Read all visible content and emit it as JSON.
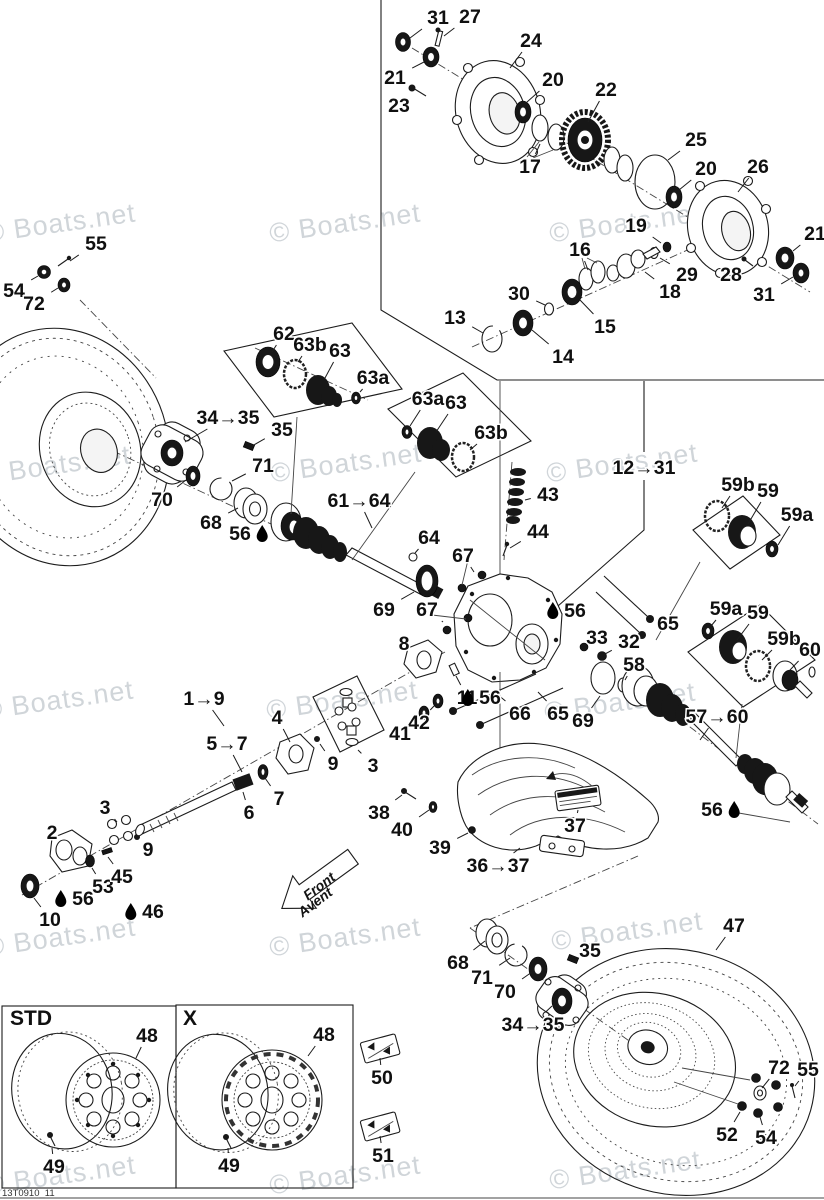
{
  "watermark": {
    "text": "© Boats.net",
    "color": "#c5cbd0",
    "positions": [
      [
        60,
        223
      ],
      [
        345,
        223
      ],
      [
        625,
        223
      ],
      [
        55,
        465
      ],
      [
        346,
        463
      ],
      [
        622,
        463
      ],
      [
        58,
        700
      ],
      [
        342,
        700
      ],
      [
        620,
        702
      ],
      [
        60,
        937
      ],
      [
        345,
        937
      ],
      [
        627,
        931
      ],
      [
        60,
        1175
      ],
      [
        345,
        1175
      ],
      [
        625,
        1170
      ]
    ]
  },
  "footer_code": "13T0910_11",
  "front_arrow": {
    "line1": "Front",
    "line2": "Avent"
  },
  "boxes": {
    "std_label": "STD",
    "x_label": "X"
  },
  "callouts": [
    {
      "t": "31",
      "x": 438,
      "y": 17,
      "lx": 410,
      "ly": 38
    },
    {
      "t": "27",
      "x": 470,
      "y": 16,
      "lx": 444,
      "ly": 36
    },
    {
      "t": "24",
      "x": 531,
      "y": 40,
      "lx": 510,
      "ly": 68
    },
    {
      "t": "21",
      "x": 395,
      "y": 77,
      "lx": 424,
      "ly": 62
    },
    {
      "t": "23",
      "x": 399,
      "y": 105,
      "lx": 412,
      "ly": 93
    },
    {
      "t": "20",
      "x": 553,
      "y": 79,
      "lx": 527,
      "ly": 102
    },
    {
      "t": "22",
      "x": 606,
      "y": 89,
      "lx": 588,
      "ly": 122
    },
    {
      "t": "17",
      "x": 530,
      "y": 166,
      "lx": 540,
      "ly": 144
    },
    {
      "t": "25",
      "x": 696,
      "y": 139,
      "lx": 668,
      "ly": 160
    },
    {
      "t": "20",
      "x": 706,
      "y": 168,
      "lx": 679,
      "ly": 190
    },
    {
      "t": "26",
      "x": 758,
      "y": 166,
      "lx": 738,
      "ly": 192
    },
    {
      "t": "21",
      "x": 815,
      "y": 233,
      "lx": 793,
      "ly": 251
    },
    {
      "t": "31",
      "x": 764,
      "y": 294,
      "lx": 793,
      "ly": 277
    },
    {
      "t": "28",
      "x": 731,
      "y": 274,
      "lx": 744,
      "ly": 263
    },
    {
      "t": "29",
      "x": 687,
      "y": 274,
      "lx": 660,
      "ly": 258
    },
    {
      "t": "18",
      "x": 670,
      "y": 291,
      "lx": 645,
      "ly": 272
    },
    {
      "t": "19",
      "x": 636,
      "y": 225,
      "lx": 661,
      "ly": 243
    },
    {
      "t": "16",
      "x": 580,
      "y": 249,
      "lx": 588,
      "ly": 270
    },
    {
      "t": "15",
      "x": 605,
      "y": 326,
      "lx": 580,
      "ly": 300
    },
    {
      "t": "13",
      "x": 455,
      "y": 317,
      "lx": 483,
      "ly": 333
    },
    {
      "t": "30",
      "x": 519,
      "y": 293,
      "lx": 545,
      "ly": 305
    },
    {
      "t": "14",
      "x": 563,
      "y": 356,
      "lx": 532,
      "ly": 330
    },
    {
      "t": "55",
      "x": 96,
      "y": 243,
      "lx": 70,
      "ly": 261
    },
    {
      "t": "54",
      "x": 14,
      "y": 290,
      "lx": 38,
      "ly": 276
    },
    {
      "t": "72",
      "x": 34,
      "y": 303,
      "lx": 58,
      "ly": 288
    },
    {
      "t": "62",
      "x": 284,
      "y": 333,
      "lx": 272,
      "ly": 352
    },
    {
      "t": "63b",
      "x": 310,
      "y": 344,
      "lx": 298,
      "ly": 362
    },
    {
      "t": "63",
      "x": 340,
      "y": 350,
      "lx": 325,
      "ly": 378
    },
    {
      "t": "63a",
      "x": 373,
      "y": 377,
      "lx": 360,
      "ly": 392
    },
    {
      "t": "34→35",
      "x": 228,
      "y": 417,
      "lx": 185,
      "ly": 442
    },
    {
      "t": "35",
      "x": 282,
      "y": 429,
      "lx": 252,
      "ly": 446
    },
    {
      "t": "71",
      "x": 263,
      "y": 465,
      "lx": 232,
      "ly": 481
    },
    {
      "t": "70",
      "x": 162,
      "y": 499,
      "lx": 186,
      "ly": 480
    },
    {
      "t": "68",
      "x": 211,
      "y": 522,
      "lx": 238,
      "ly": 508
    },
    {
      "t": "56",
      "x": 240,
      "y": 533,
      "lube": "after"
    },
    {
      "t": "61→64",
      "x": 359,
      "y": 500,
      "lx": 372,
      "ly": 528
    },
    {
      "t": "63a",
      "x": 428,
      "y": 398,
      "lx": 410,
      "ly": 426
    },
    {
      "t": "63",
      "x": 456,
      "y": 402,
      "lx": 436,
      "ly": 432
    },
    {
      "t": "63b",
      "x": 491,
      "y": 432,
      "lx": 470,
      "ly": 450
    },
    {
      "t": "43",
      "x": 548,
      "y": 494,
      "lx": 525,
      "ly": 500
    },
    {
      "t": "44",
      "x": 538,
      "y": 531,
      "lx": 510,
      "ly": 548
    },
    {
      "t": "64",
      "x": 429,
      "y": 537,
      "lx": 415,
      "ly": 553
    },
    {
      "t": "67",
      "x": 463,
      "y": 555,
      "lx": 474,
      "ly": 572
    },
    {
      "t": "67",
      "x": 427,
      "y": 609,
      "lx": 443,
      "ly": 622
    },
    {
      "t": "56",
      "x": 575,
      "y": 610,
      "lube": "before"
    },
    {
      "t": "33",
      "x": 597,
      "y": 637,
      "lx": 585,
      "ly": 646
    },
    {
      "t": "32",
      "x": 629,
      "y": 641,
      "lx": 605,
      "ly": 654
    },
    {
      "t": "58",
      "x": 634,
      "y": 664,
      "lx": 625,
      "ly": 680
    },
    {
      "t": "65",
      "x": 668,
      "y": 623,
      "lx": 652,
      "ly": 616
    },
    {
      "t": "66",
      "x": 520,
      "y": 713,
      "lx": 497,
      "ly": 694
    },
    {
      "t": "65",
      "x": 558,
      "y": 713,
      "lx": 538,
      "ly": 692
    },
    {
      "t": "69",
      "x": 583,
      "y": 720,
      "lx": 600,
      "ly": 696
    },
    {
      "t": "11",
      "x": 467,
      "y": 697,
      "lx": 456,
      "ly": 676
    },
    {
      "t": "56",
      "x": 490,
      "y": 697,
      "lube": "before"
    },
    {
      "t": "8",
      "x": 404,
      "y": 643,
      "lx": 414,
      "ly": 655
    },
    {
      "t": "42",
      "x": 419,
      "y": 722,
      "lx": 434,
      "ly": 706
    },
    {
      "t": "41",
      "x": 400,
      "y": 733,
      "lx": 421,
      "ly": 717
    },
    {
      "t": "69",
      "x": 384,
      "y": 609,
      "lx": 414,
      "ly": 592
    },
    {
      "t": "12→31",
      "x": 644,
      "y": 467
    },
    {
      "t": "1→9",
      "x": 204,
      "y": 698,
      "lx": 224,
      "ly": 726
    },
    {
      "t": "5→7",
      "x": 227,
      "y": 743,
      "lx": 242,
      "ly": 772
    },
    {
      "t": "4",
      "x": 277,
      "y": 717,
      "lx": 290,
      "ly": 742
    },
    {
      "t": "9",
      "x": 333,
      "y": 763,
      "lx": 320,
      "ly": 744
    },
    {
      "t": "3",
      "x": 373,
      "y": 765,
      "lx": 358,
      "ly": 750
    },
    {
      "t": "7",
      "x": 279,
      "y": 798,
      "lx": 265,
      "ly": 778
    },
    {
      "t": "6",
      "x": 249,
      "y": 812,
      "lx": 243,
      "ly": 792
    },
    {
      "t": "2",
      "x": 52,
      "y": 832,
      "lx": 62,
      "ly": 844
    },
    {
      "t": "3",
      "x": 105,
      "y": 807,
      "lx": 117,
      "ly": 822
    },
    {
      "t": "9",
      "x": 148,
      "y": 849,
      "lx": 139,
      "ly": 839
    },
    {
      "t": "53",
      "x": 103,
      "y": 886,
      "lx": 92,
      "ly": 868
    },
    {
      "t": "45",
      "x": 122,
      "y": 876,
      "lx": 108,
      "ly": 857
    },
    {
      "t": "56",
      "x": 83,
      "y": 898,
      "lube": "before"
    },
    {
      "t": "46",
      "x": 153,
      "y": 911,
      "lube": "before"
    },
    {
      "t": "10",
      "x": 50,
      "y": 919,
      "lx": 34,
      "ly": 898
    },
    {
      "t": "38",
      "x": 379,
      "y": 812,
      "lx": 402,
      "ly": 795
    },
    {
      "t": "40",
      "x": 402,
      "y": 829,
      "lx": 429,
      "ly": 810
    },
    {
      "t": "39",
      "x": 440,
      "y": 847,
      "lx": 468,
      "ly": 833
    },
    {
      "t": "36→37",
      "x": 498,
      "y": 865,
      "lx": 520,
      "ly": 848
    },
    {
      "t": "37",
      "x": 575,
      "y": 825,
      "lx": 578,
      "ly": 810
    },
    {
      "t": "59b",
      "x": 738,
      "y": 484,
      "lx": 722,
      "ly": 508
    },
    {
      "t": "59",
      "x": 768,
      "y": 490,
      "lx": 748,
      "ly": 524
    },
    {
      "t": "59a",
      "x": 797,
      "y": 514,
      "lx": 778,
      "ly": 545
    },
    {
      "t": "59a",
      "x": 726,
      "y": 608,
      "lx": 711,
      "ly": 626
    },
    {
      "t": "59",
      "x": 758,
      "y": 612,
      "lx": 737,
      "ly": 640
    },
    {
      "t": "59b",
      "x": 784,
      "y": 638,
      "lx": 762,
      "ly": 660
    },
    {
      "t": "60",
      "x": 810,
      "y": 649,
      "lx": 790,
      "ly": 670
    },
    {
      "t": "57→60",
      "x": 717,
      "y": 716,
      "lx": 700,
      "ly": 740
    },
    {
      "t": "56",
      "x": 712,
      "y": 809,
      "lube": "after"
    },
    {
      "t": "47",
      "x": 734,
      "y": 925,
      "lx": 716,
      "ly": 950
    },
    {
      "t": "68",
      "x": 458,
      "y": 962,
      "lx": 485,
      "ly": 941
    },
    {
      "t": "71",
      "x": 482,
      "y": 977,
      "lx": 510,
      "ly": 958
    },
    {
      "t": "70",
      "x": 505,
      "y": 991,
      "lx": 532,
      "ly": 972
    },
    {
      "t": "35",
      "x": 590,
      "y": 950,
      "lx": 574,
      "ly": 959
    },
    {
      "t": "34→35",
      "x": 533,
      "y": 1024,
      "lx": 552,
      "ly": 1006
    },
    {
      "t": "72",
      "x": 779,
      "y": 1067,
      "lx": 762,
      "ly": 1088
    },
    {
      "t": "55",
      "x": 808,
      "y": 1069,
      "lx": 795,
      "ly": 1086
    },
    {
      "t": "52",
      "x": 727,
      "y": 1134,
      "lx": 740,
      "ly": 1112
    },
    {
      "t": "54",
      "x": 766,
      "y": 1137,
      "lx": 760,
      "ly": 1117
    },
    {
      "t": "48",
      "x": 147,
      "y": 1035,
      "lx": 136,
      "ly": 1058
    },
    {
      "t": "49",
      "x": 54,
      "y": 1166,
      "lx": 52,
      "ly": 1148
    },
    {
      "t": "48",
      "x": 324,
      "y": 1034,
      "lx": 308,
      "ly": 1056
    },
    {
      "t": "49",
      "x": 229,
      "y": 1165,
      "lx": 228,
      "ly": 1148
    },
    {
      "t": "50",
      "x": 382,
      "y": 1077,
      "lx": 380,
      "ly": 1058
    },
    {
      "t": "51",
      "x": 383,
      "y": 1155,
      "lx": 380,
      "ly": 1136
    }
  ]
}
